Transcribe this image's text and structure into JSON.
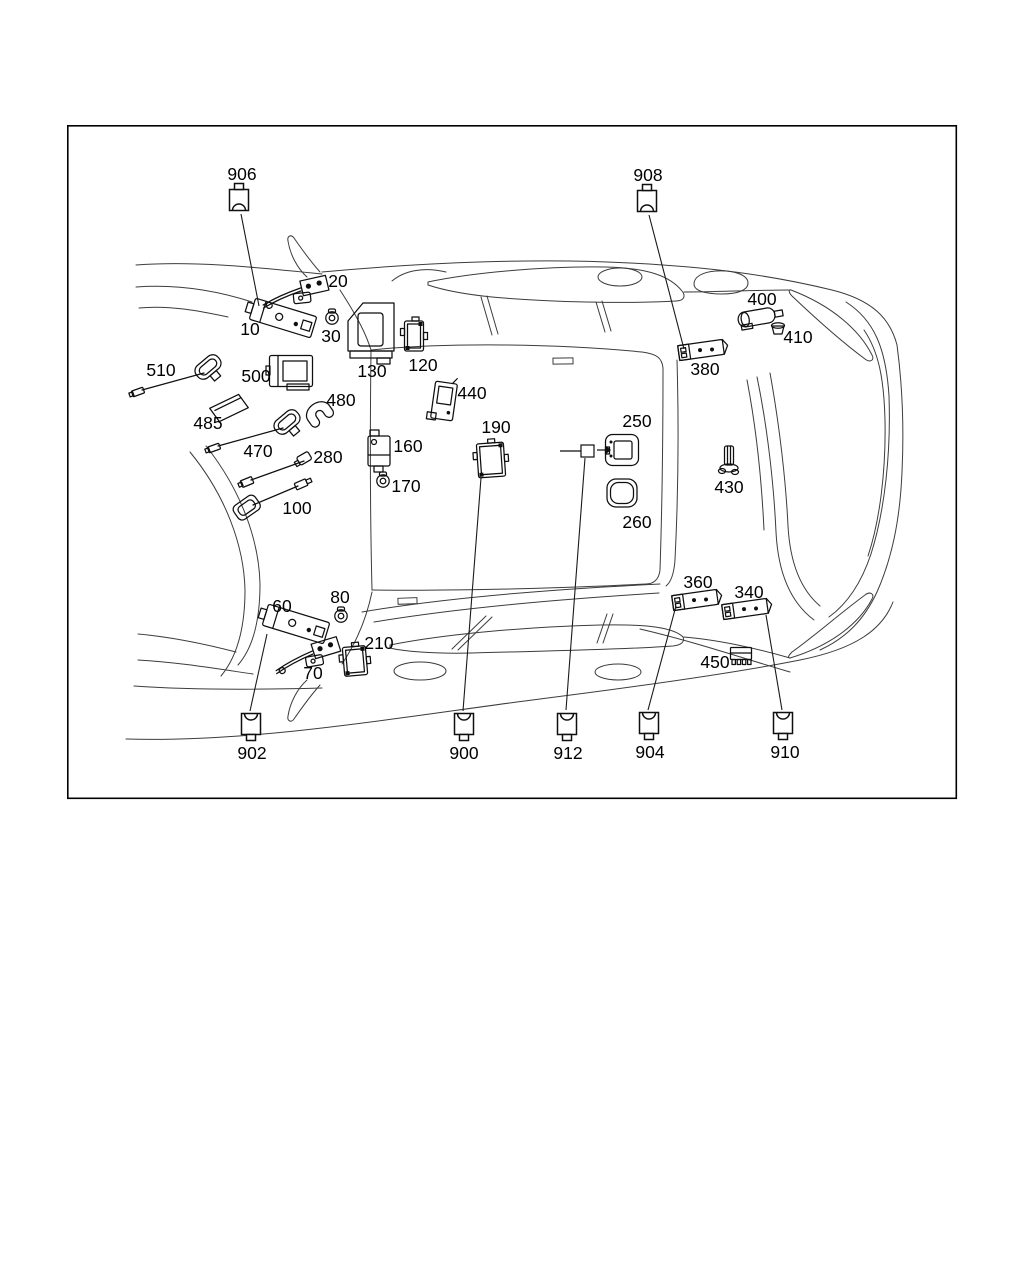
{
  "frame": {
    "x": 67,
    "y": 125,
    "width": 890,
    "height": 674,
    "border_color": "#000000",
    "background": "#ffffff"
  },
  "diagram": {
    "line_color": "#3c3c3c",
    "label_color": "#000000",
    "parts": [
      {
        "number": "10",
        "label": {
          "x": 250,
          "y": 329
        },
        "glyph": {
          "type": "amp",
          "x": 283,
          "y": 318,
          "rot": 17
        }
      },
      {
        "number": "20",
        "label": {
          "x": 338,
          "y": 281
        },
        "glyph": {
          "type": "link",
          "x": 301,
          "y": 292,
          "rot": -6
        }
      },
      {
        "number": "30",
        "label": {
          "x": 331,
          "y": 336
        },
        "glyph": {
          "type": "grom",
          "x": 332,
          "y": 317,
          "rot": 0
        }
      },
      {
        "number": "60",
        "label": {
          "x": 282,
          "y": 606
        },
        "glyph": {
          "type": "amp",
          "x": 296,
          "y": 624,
          "rot": 17
        }
      },
      {
        "number": "70",
        "label": {
          "x": 313,
          "y": 673
        },
        "glyph": {
          "type": "link",
          "x": 313,
          "y": 655,
          "rot": -10
        }
      },
      {
        "number": "80",
        "label": {
          "x": 340,
          "y": 597
        },
        "glyph": {
          "type": "grom",
          "x": 341,
          "y": 615,
          "rot": 0
        }
      },
      {
        "number": "100",
        "label": {
          "x": 297,
          "y": 508
        },
        "glyph": {
          "type": "gps",
          "x": 247,
          "y": 508,
          "x2": 302,
          "y2": 484,
          "rot": -35
        }
      },
      {
        "number": "120",
        "label": {
          "x": 423,
          "y": 365
        },
        "glyph": {
          "type": "modt",
          "x": 414,
          "y": 336,
          "w": 19,
          "h": 30,
          "rot": 0
        }
      },
      {
        "number": "130",
        "label": {
          "x": 372,
          "y": 371
        },
        "glyph": {
          "type": "bracket",
          "x": 371,
          "y": 330,
          "rot": 0
        }
      },
      {
        "number": "160",
        "label": {
          "x": 408,
          "y": 446
        },
        "glyph": {
          "type": "relay",
          "x": 379,
          "y": 451,
          "rot": 0
        }
      },
      {
        "number": "170",
        "label": {
          "x": 406,
          "y": 486
        },
        "glyph": {
          "type": "grom",
          "x": 383,
          "y": 480,
          "rot": 0
        }
      },
      {
        "number": "190",
        "label": {
          "x": 496,
          "y": 427
        },
        "glyph": {
          "type": "modt",
          "x": 491,
          "y": 460,
          "w": 27,
          "h": 34,
          "rot": -4
        }
      },
      {
        "number": "210",
        "label": {
          "x": 379,
          "y": 643
        },
        "glyph": {
          "type": "modt",
          "x": 355,
          "y": 661,
          "w": 23,
          "h": 29,
          "rot": -5
        }
      },
      {
        "number": "250",
        "label": {
          "x": 637,
          "y": 421
        },
        "glyph": {
          "type": "frame",
          "x": 622,
          "y": 450,
          "rot": 0
        }
      },
      {
        "number": "260",
        "label": {
          "x": 637,
          "y": 522
        },
        "glyph": {
          "type": "pad",
          "x": 622,
          "y": 493,
          "rot": 0
        }
      },
      {
        "number": "280",
        "label": {
          "x": 328,
          "y": 457
        },
        "glyph": {
          "type": "cable",
          "x": 304,
          "y": 459,
          "x2": 247,
          "y2": 482,
          "rot": -30
        }
      },
      {
        "number": "340",
        "label": {
          "x": 749,
          "y": 592
        },
        "glyph": {
          "type": "ampsm",
          "x": 745,
          "y": 609,
          "rot": -8
        }
      },
      {
        "number": "360",
        "label": {
          "x": 698,
          "y": 582
        },
        "glyph": {
          "type": "ampsm",
          "x": 695,
          "y": 600,
          "rot": -8
        }
      },
      {
        "number": "380",
        "label": {
          "x": 705,
          "y": 369
        },
        "glyph": {
          "type": "ampsm",
          "x": 701,
          "y": 350,
          "rot": -8
        }
      },
      {
        "number": "400",
        "label": {
          "x": 762,
          "y": 299
        },
        "glyph": {
          "type": "cyl",
          "x": 759,
          "y": 317,
          "rot": -10
        }
      },
      {
        "number": "410",
        "label": {
          "x": 798,
          "y": 337
        },
        "glyph": {
          "type": "cap",
          "x": 778,
          "y": 329,
          "rot": 0
        }
      },
      {
        "number": "430",
        "label": {
          "x": 729,
          "y": 487
        },
        "glyph": {
          "type": "antb",
          "x": 729,
          "y": 460,
          "rot": 0
        }
      },
      {
        "number": "440",
        "label": {
          "x": 472,
          "y": 393
        },
        "glyph": {
          "type": "modv",
          "x": 444,
          "y": 401,
          "rot": 8
        }
      },
      {
        "number": "450",
        "label": {
          "x": 715,
          "y": 662
        },
        "glyph": {
          "type": "connb",
          "x": 741,
          "y": 656,
          "rot": 0
        }
      },
      {
        "number": "470",
        "label": {
          "x": 258,
          "y": 451
        },
        "glyph": {
          "type": "ant",
          "x": 287,
          "y": 422,
          "x2": 214,
          "y2": 448,
          "rot": -40
        }
      },
      {
        "number": "480",
        "label": {
          "x": 341,
          "y": 400
        },
        "glyph": {
          "type": "clip",
          "x": 318,
          "y": 412,
          "rot": -35
        }
      },
      {
        "number": "485",
        "label": {
          "x": 208,
          "y": 423
        },
        "glyph": {
          "type": "plate",
          "x": 229,
          "y": 408,
          "rot": -22
        }
      },
      {
        "number": "500",
        "label": {
          "x": 256,
          "y": 376
        },
        "glyph": {
          "type": "modb",
          "x": 291,
          "y": 371,
          "rot": 0
        }
      },
      {
        "number": "510",
        "label": {
          "x": 161,
          "y": 370
        },
        "glyph": {
          "type": "ant",
          "x": 208,
          "y": 367,
          "x2": 138,
          "y2": 392,
          "rot": -40
        }
      }
    ],
    "connectors": [
      {
        "number": "906",
        "x": 239,
        "y": 200,
        "orient": "up",
        "label": {
          "x": 242,
          "y": 174
        }
      },
      {
        "number": "908",
        "x": 647,
        "y": 201,
        "orient": "up",
        "label": {
          "x": 648,
          "y": 175
        }
      },
      {
        "number": "902",
        "x": 251,
        "y": 724,
        "orient": "down",
        "label": {
          "x": 252,
          "y": 753
        }
      },
      {
        "number": "900",
        "x": 464,
        "y": 724,
        "orient": "down",
        "label": {
          "x": 464,
          "y": 753
        }
      },
      {
        "number": "912",
        "x": 567,
        "y": 724,
        "orient": "down",
        "label": {
          "x": 568,
          "y": 753
        }
      },
      {
        "number": "904",
        "x": 649,
        "y": 723,
        "orient": "down",
        "label": {
          "x": 650,
          "y": 752
        }
      },
      {
        "number": "910",
        "x": 783,
        "y": 723,
        "orient": "down",
        "label": {
          "x": 785,
          "y": 752
        }
      }
    ],
    "leader_lines": [
      {
        "from": "906",
        "x1": 241,
        "y1": 214,
        "x2": 259,
        "y2": 306
      },
      {
        "from": "908",
        "x1": 649,
        "y1": 215,
        "x2": 684,
        "y2": 349
      },
      {
        "from": "902",
        "x1": 250,
        "y1": 711,
        "x2": 267,
        "y2": 634
      },
      {
        "from": "900",
        "x1": 463,
        "y1": 711,
        "x2": 481,
        "y2": 478
      },
      {
        "from": "912",
        "x1": 566,
        "y1": 710,
        "x2": 585,
        "y2": 458
      },
      {
        "from": "904",
        "x1": 648,
        "y1": 710,
        "x2": 676,
        "y2": 606
      },
      {
        "from": "910",
        "x1": 782,
        "y1": 710,
        "x2": 766,
        "y2": 615
      }
    ],
    "pointer_912": {
      "line_x1": 560,
      "line_y": 451,
      "square_x": 581,
      "square_y": 445,
      "square_w": 13,
      "square_h": 12,
      "arrow_x1": 597,
      "arrow_x2": 611,
      "arrow_y": 450
    }
  }
}
